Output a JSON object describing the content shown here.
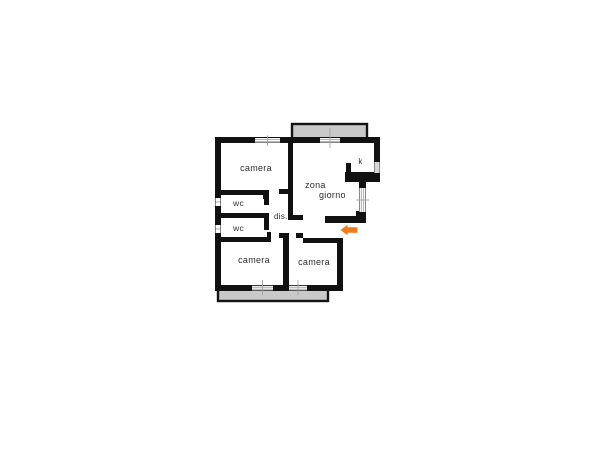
{
  "colors": {
    "background": "#ffffff",
    "wall": "#111111",
    "balcony_fill": "#c9c9c9",
    "balcony_border": "#141414",
    "window_fill": "#ffffff",
    "window_line": "#9b9b9b",
    "label": "#2e2e2e",
    "arrow": "#ee7c1d"
  },
  "labels": {
    "camera_top": "camera",
    "zona_line1": "zona",
    "zona_line2": "giorno",
    "kitchen": "k",
    "wc_upper": "wc",
    "wc_lower": "wc",
    "dis": "dis.",
    "camera_bottom_left": "camera",
    "camera_bottom_right": "camera"
  },
  "arrow": {
    "direction": "left",
    "meaning": "entrance"
  }
}
